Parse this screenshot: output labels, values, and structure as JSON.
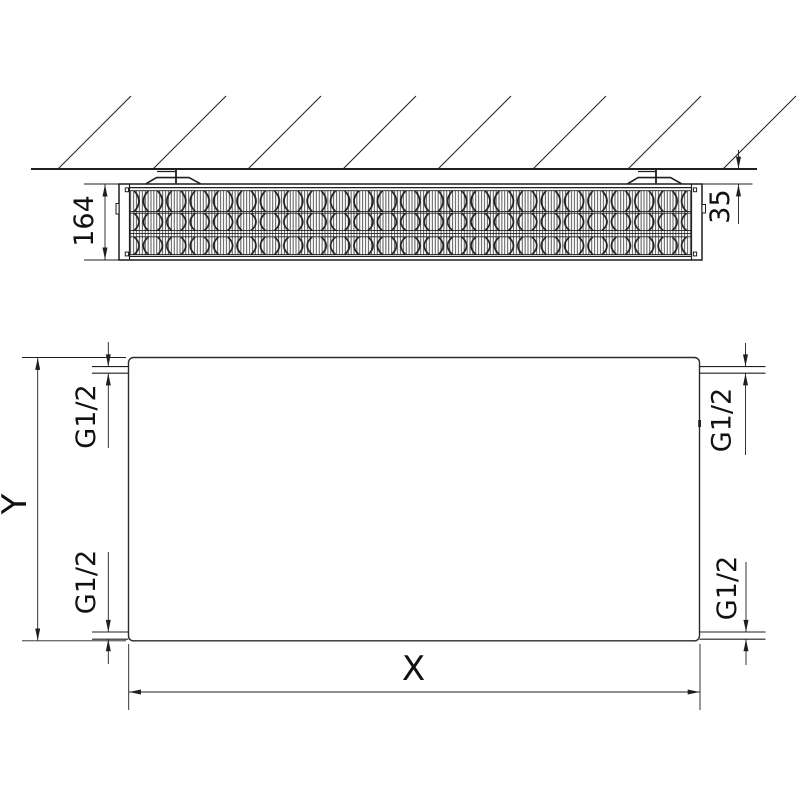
{
  "diagram": {
    "background": "#ffffff",
    "line_color": "#1f1f1f",
    "top_view": {
      "depth_label": "164",
      "wall_gap_label": "35"
    },
    "front_view": {
      "height_label": "Y",
      "width_label": "X",
      "connections": {
        "top_left": {
          "label": "G1/2"
        },
        "top_right": {
          "label": "G1/2"
        },
        "bottom_left": {
          "label": "G1/2"
        },
        "bottom_right": {
          "label": "G1/2"
        }
      }
    }
  }
}
